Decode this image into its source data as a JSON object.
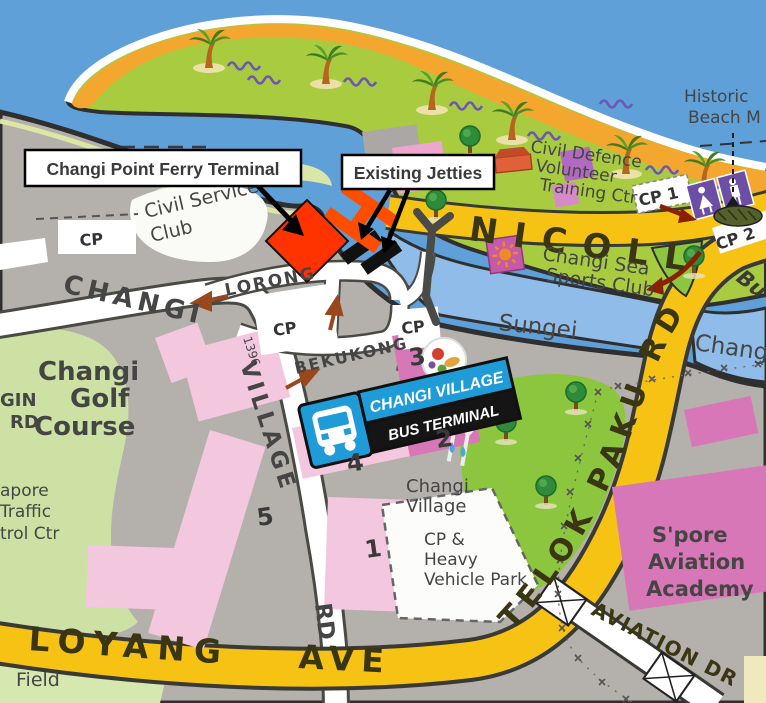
{
  "callouts": {
    "ferry_terminal": "Changi Point Ferry Terminal",
    "existing_jetties": "Existing Jetties"
  },
  "roads": {
    "nicoll": "NICOLL",
    "telok_paku_rd": "TELOK PAKU RD",
    "loyang": "LOYANG",
    "ave": "AVE",
    "aviation_dr": "AVIATION DR",
    "changi": "CHANGI",
    "village": "VILLAGE",
    "rd": "RD",
    "lorong": "LORONG",
    "bekukong": "BEKUKONG",
    "post_number": "1396",
    "gin": "GIN",
    "gin_rd": "RD"
  },
  "places": {
    "civil_service_club": [
      "Civil Service",
      "Club"
    ],
    "civil_defence": [
      "Civil Defence",
      "Volunteer",
      "Training Ctr"
    ],
    "sea_sports": [
      "Changi Sea",
      "Sports Club"
    ],
    "sungei": "Sungei",
    "sungei_changi": "Changi",
    "bu": "Bu",
    "historic_beach": [
      "Historic",
      "Beach M"
    ],
    "golf": [
      "Changi",
      "Golf",
      "Course"
    ],
    "traffic_ctrl": [
      "apore",
      "Traffic",
      "trol Ctr"
    ],
    "changi_village": [
      "Changi",
      "Village"
    ],
    "heavy_vehicle": [
      "CP &",
      "Heavy",
      "Vehicle Park"
    ],
    "aviation_academy": [
      "S'pore",
      "Aviation",
      "Academy"
    ],
    "field": "Field"
  },
  "bus_terminal": {
    "top": "CHANGI VILLAGE",
    "bottom": "BUS TERMINAL"
  },
  "carparks": {
    "cp": "CP",
    "cp1": "CP 1",
    "cp2": "CP 2"
  },
  "blocks": {
    "b1": "1",
    "b2": "2",
    "b3": "3",
    "b4": "4",
    "b5": "5"
  },
  "colors": {
    "sea": "#5FA0D8",
    "river": "#8FBCE8",
    "land": "#B4B0AC",
    "strip_green": "#A8CB40",
    "sand": "#F3A72E",
    "road_yellow": "#F6C315",
    "golf_green": "#CCE1A3",
    "park_green": "#8CC63F",
    "pink": "#F3C7DD",
    "magenta": "#D877B7",
    "accent_red": "#FF3300",
    "sign_blue": "#1F9CD8"
  }
}
